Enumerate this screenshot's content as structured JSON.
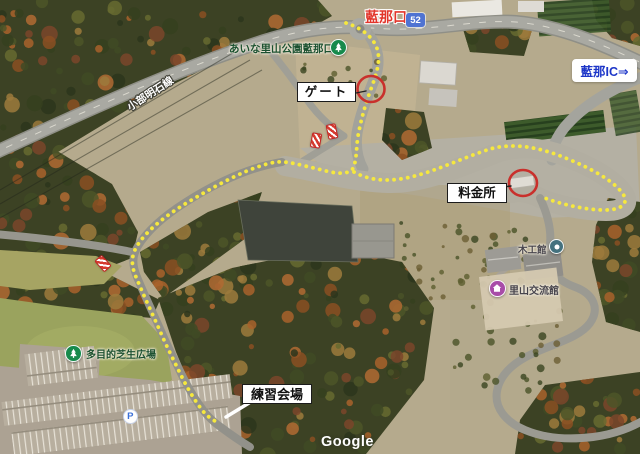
{
  "map": {
    "type": "satellite",
    "attribution": "Google"
  },
  "annotations": {
    "entrance_name": "藍那口",
    "route_shield": "52",
    "park_entrance": "あいな里山公園藍那口",
    "road_name": "小部明石線",
    "gate_label": "ゲート",
    "ic_label": "藍那IC⇒",
    "toll_label": "料金所",
    "woodcraft_label": "木工館",
    "community_label": "里山交流館",
    "lawn_label": "多目的芝生広場",
    "practice_label": "練習会場",
    "parking_label": "P"
  },
  "colors": {
    "route_yellow": "#f6e83e",
    "highlight_red": "#c9302c",
    "entrance_red": "#e2352b",
    "shield_blue": "#4f73d2",
    "park_green": "#178a4c",
    "poi_purple": "#a84ca8",
    "poi_teal": "#44717e",
    "ic_blue": "#1d36c8",
    "parking_blue": "#3a6fd8",
    "park_text_green": "#1c5130",
    "poi_text_dark": "#47444c"
  }
}
